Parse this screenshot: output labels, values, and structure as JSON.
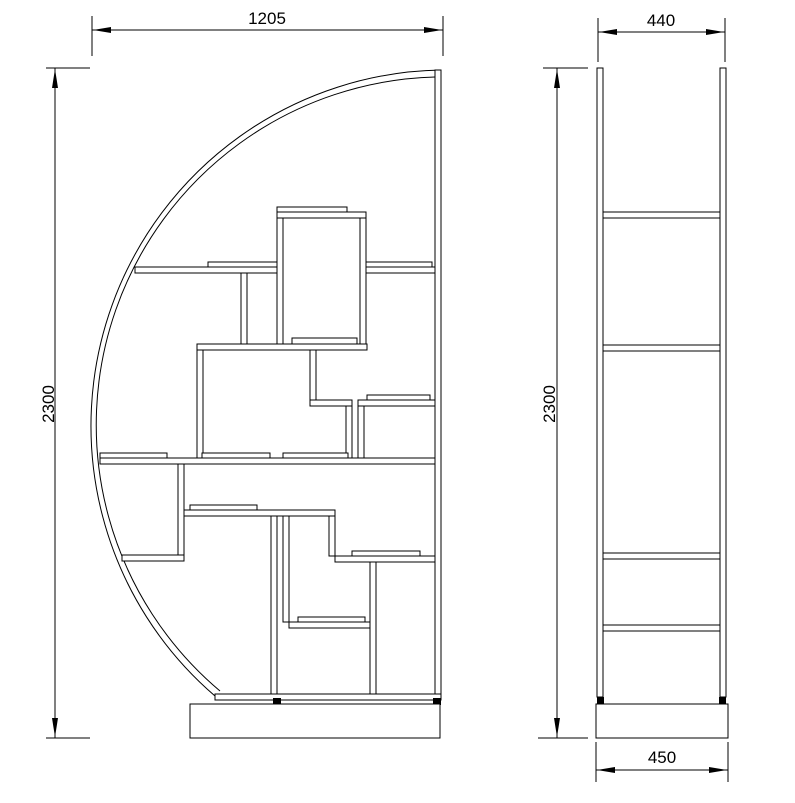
{
  "drawing": {
    "type": "technical-drawing",
    "colors": {
      "background": "#ffffff",
      "line": "#000000"
    },
    "front_view": {
      "width_dimension": "1205",
      "height_dimension": "2300"
    },
    "side_view": {
      "top_depth_dimension": "440",
      "height_dimension": "2300",
      "base_depth_dimension": "450"
    }
  }
}
